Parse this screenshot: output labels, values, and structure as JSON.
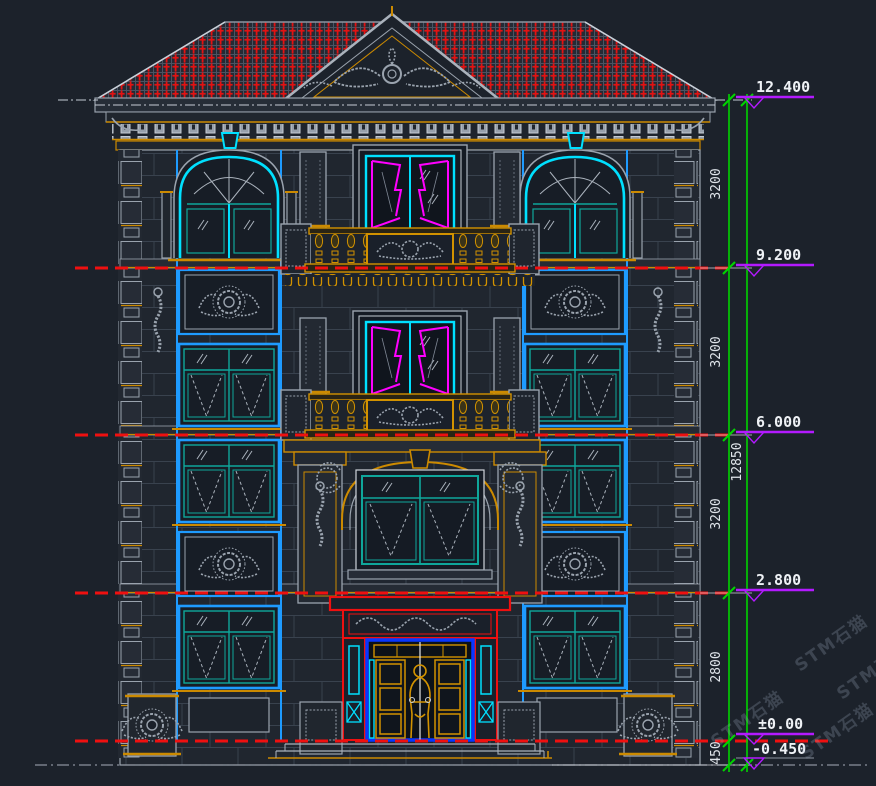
{
  "drawing": {
    "type": "architectural-front-elevation",
    "style": "cad-dark-model-space"
  },
  "colors": {
    "background": "#1c222b",
    "line_gray": "#9aa3ae",
    "bright_gray": "#c9d0d8",
    "gold": "#cc8a00",
    "cyan": "#00e0ff",
    "teal": "#0fa79b",
    "tower_blue": "#1e9bff",
    "door_blue": "#0837ff",
    "curtain_magenta": "#ff00ff",
    "roof_red": "#e31212",
    "level_red": "#ef1010",
    "dim_green": "#00d400",
    "marker_purple": "#b31aff",
    "text_white": "#eef1f5"
  },
  "dimensions": {
    "floor_dims": [
      {
        "value": "3200"
      },
      {
        "value": "3200"
      },
      {
        "value": "3200"
      },
      {
        "value": "2800"
      },
      {
        "value": "450"
      }
    ],
    "overall_dim": {
      "value": "12850"
    }
  },
  "elevation_markers": [
    {
      "label": "12.400"
    },
    {
      "label": "9.200"
    },
    {
      "label": "6.000"
    },
    {
      "label": "2.800"
    },
    {
      "label": "±0.00"
    },
    {
      "label": "-0.450"
    }
  ],
  "watermark": {
    "text": "STM石猫"
  }
}
